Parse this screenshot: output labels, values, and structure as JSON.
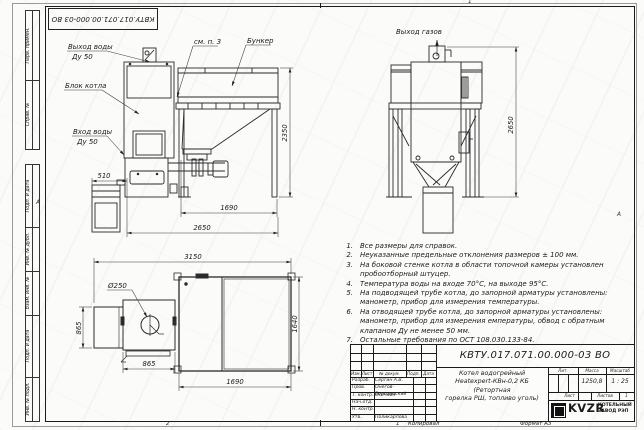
{
  "doc": {
    "designation": "КВТУ.017.071.00.000-03 ВО"
  },
  "frame": {
    "left_top": [
      "Перв. примен.",
      "Справ. №"
    ],
    "left_bottom": [
      "Подп. и дата",
      "Инв. № дубл.",
      "Взам. инв. №",
      "Подп. и дата",
      "Инв. № подл."
    ],
    "zone_left": "А",
    "zone_right": "А",
    "zone_top": "1",
    "footer_zone": "2",
    "footer_num": "1",
    "copied": "Копировал",
    "format": "Формат А3"
  },
  "front_view": {
    "water_out_1": "Выход воды",
    "water_out_2": "Ду 50",
    "boiler": "Блок котла",
    "water_in_1": "Вход воды",
    "water_in_2": "Ду 50",
    "see_note": "см. п. 3",
    "bunker": "Бункер",
    "dim_510": "510",
    "dim_1690": "1690",
    "dim_2650": "2650",
    "dim_2350": "2350"
  },
  "cyclone_view": {
    "gas_out": "Выход газов",
    "dim_2650": "2650"
  },
  "plan_view": {
    "d250": "Ø250",
    "dim_3150": "3150",
    "dim_865_left": "865",
    "dim_865_bottom": "865",
    "dim_1690": "1690",
    "dim_1640": "1640"
  },
  "notes": [
    {
      "num": "1.",
      "lines": [
        "Все размеры для справок."
      ]
    },
    {
      "num": "2.",
      "lines": [
        "Неуказанные предельные отклонения размеров ± 100 мм."
      ]
    },
    {
      "num": "3.",
      "lines": [
        "На боковой стенке котла в области топочной камеры установлен",
        "пробоотборный штуцер."
      ]
    },
    {
      "num": "4.",
      "lines": [
        "Температура воды на входе 70°С, на выходе 95°С."
      ]
    },
    {
      "num": "5.",
      "lines": [
        "На подводящей трубе котла, до запорной арматуры установлены:",
        "манометр, прибор для измерения температуры."
      ]
    },
    {
      "num": "6.",
      "lines": [
        "На отводящей трубе котла, до запорной арматуры установлены:",
        "манометр, прибор для измерения емпературы, обвод с обратным",
        "клапаном Ду не менее 50 мм."
      ]
    },
    {
      "num": "7.",
      "lines": [
        "Остальные требования по ОСТ 108.030.133-84."
      ]
    }
  ],
  "title_block": {
    "description_lines": [
      "Котел водогрейный",
      "Heatexpert-КВн-0,2 КБ (Ретортная",
      "горелка РШ, топливо уголь)"
    ],
    "header": {
      "izm": "Изм.",
      "list": "Лист",
      "doc_num": "№ докум.",
      "sign": "Подп.",
      "date": "Дата"
    },
    "rows": [
      {
        "role": "Разраб.",
        "name": "Сергин А.В."
      },
      {
        "role": "Пров.",
        "name": "Онегов-Березинский"
      },
      {
        "role": "Т. контр.",
        "name": "Осечкин"
      },
      {
        "role": "Нач.отд.",
        "name": ""
      },
      {
        "role": "Н. контр.",
        "name": ""
      },
      {
        "role": "Утв.",
        "name": "Поликарпова"
      }
    ],
    "lit_label": "Лит.",
    "mass_label": "Масса",
    "scale_label": "Масштаб",
    "mass_value": "1250,8",
    "scale_value": "1 : 25",
    "sheet_label": "Лист",
    "sheets_label": "Листов",
    "sheets_value": "1",
    "logo_text": "KVZR",
    "logo_caption": [
      "КОТЕЛЬНЫЙ",
      "ЗАВОД РЭП"
    ]
  }
}
